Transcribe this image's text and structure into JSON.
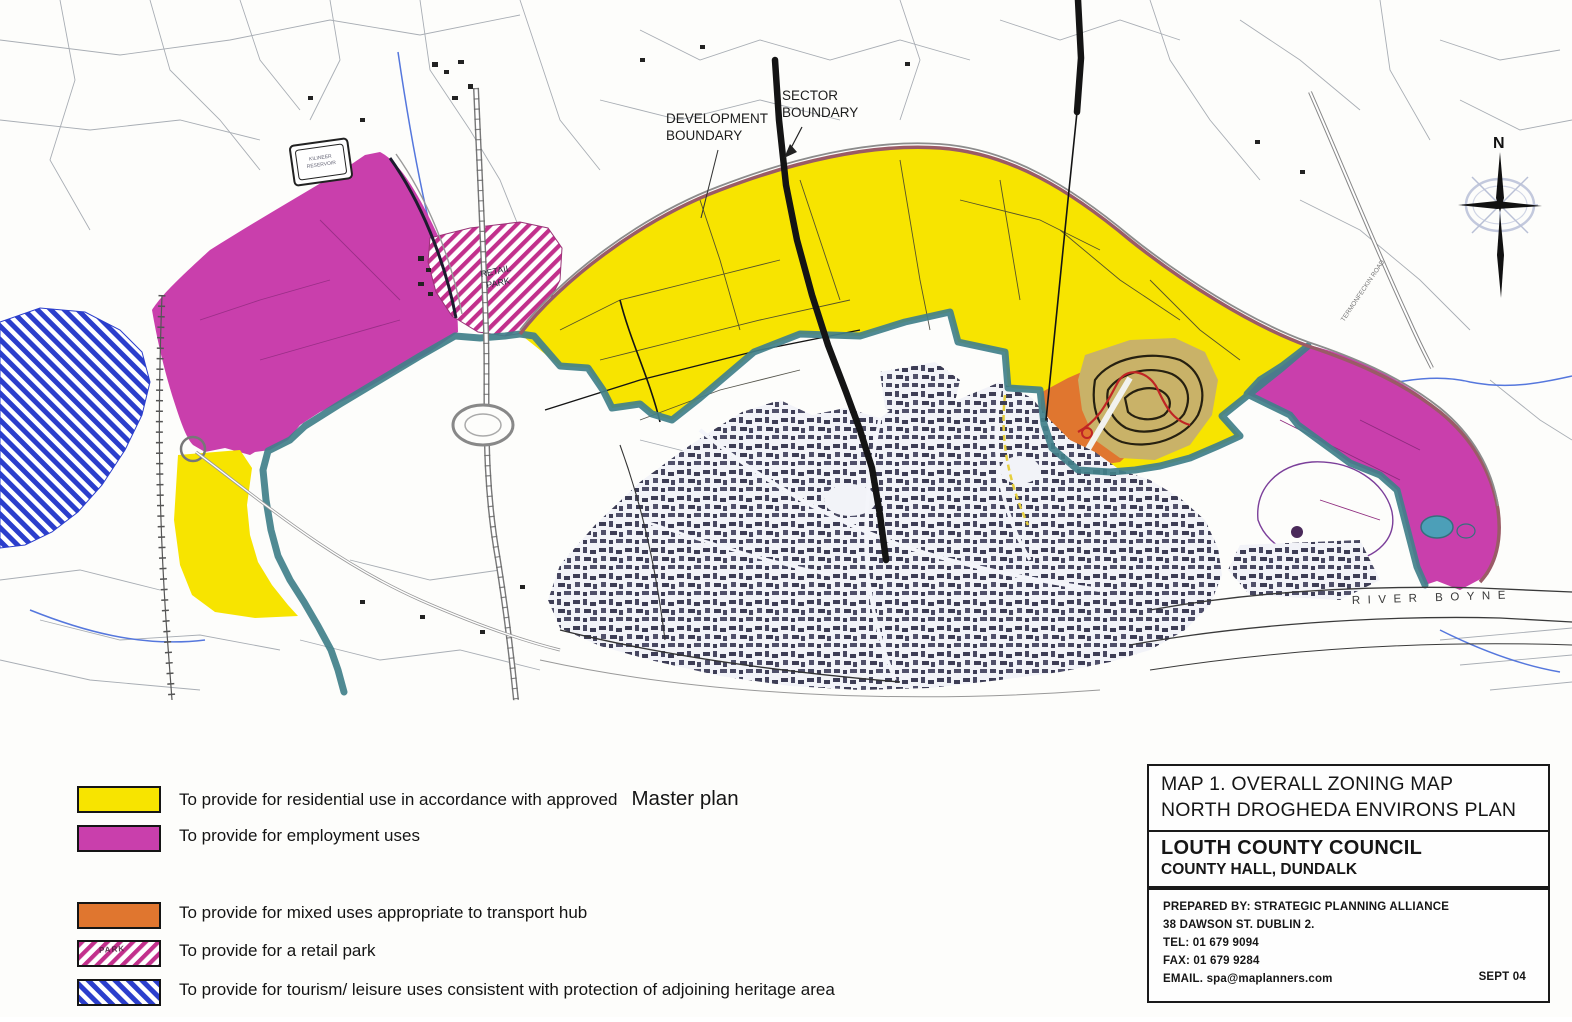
{
  "colors": {
    "residential_yellow": "#F7E400",
    "employment_magenta": "#C93FAC",
    "mixed_use_orange": "#E0762F",
    "retail_hatch_pink": "#C2308C",
    "tourism_hatch_blue": "#2B3ECC",
    "development_boundary_teal": "#41808A",
    "boundary_outer_maroon": "#9A5B66",
    "sector_boundary_black": "#141414",
    "stream_blue": "#5577DD",
    "estate_contour_tan": "#C9B268",
    "estate_road_red": "#C02525"
  },
  "legend": {
    "items": [
      {
        "id": "residential",
        "label": "To provide for residential use in accordance with approved",
        "label_suffix": "Master plan"
      },
      {
        "id": "employment",
        "label": "To provide for employment uses"
      },
      {
        "id": "mixed-use",
        "label": "To provide for mixed uses appropriate to transport hub"
      },
      {
        "id": "retail-park",
        "label": "To provide for a retail park",
        "swatch_text": "PARK"
      },
      {
        "id": "tourism-leisure",
        "label": "To provide for tourism/ leisure uses consistent with protection of adjoining heritage area"
      }
    ]
  },
  "title_block": {
    "line1": "MAP 1. OVERALL ZONING MAP",
    "line2": "NORTH DROGHEDA ENVIRONS PLAN",
    "org": "LOUTH COUNTY COUNCIL",
    "org_address": "COUNTY HALL, DUNDALK",
    "prepared_by": "PREPARED BY: STRATEGIC PLANNING ALLIANCE",
    "address": "38 DAWSON ST. DUBLIN 2.",
    "tel": "TEL: 01 679 9094",
    "fax": "FAX: 01 679 9284",
    "email": "EMAIL. spa@maplanners.com",
    "date": "SEPT 04"
  },
  "map": {
    "labels": {
      "development_boundary_1": "DEVELOPMENT",
      "development_boundary_2": "BOUNDARY",
      "sector_boundary_1": "SECTOR",
      "sector_boundary_2": "BOUNDARY",
      "river": "RIVER BOYNE",
      "road": "TERMONFECKIN ROAD",
      "reservoir_1": "KILINEER",
      "reservoir_2": "RESERVOIR",
      "retail_park_1": "RETAIL",
      "retail_park_2": "PARK",
      "compass_north": "N"
    }
  }
}
